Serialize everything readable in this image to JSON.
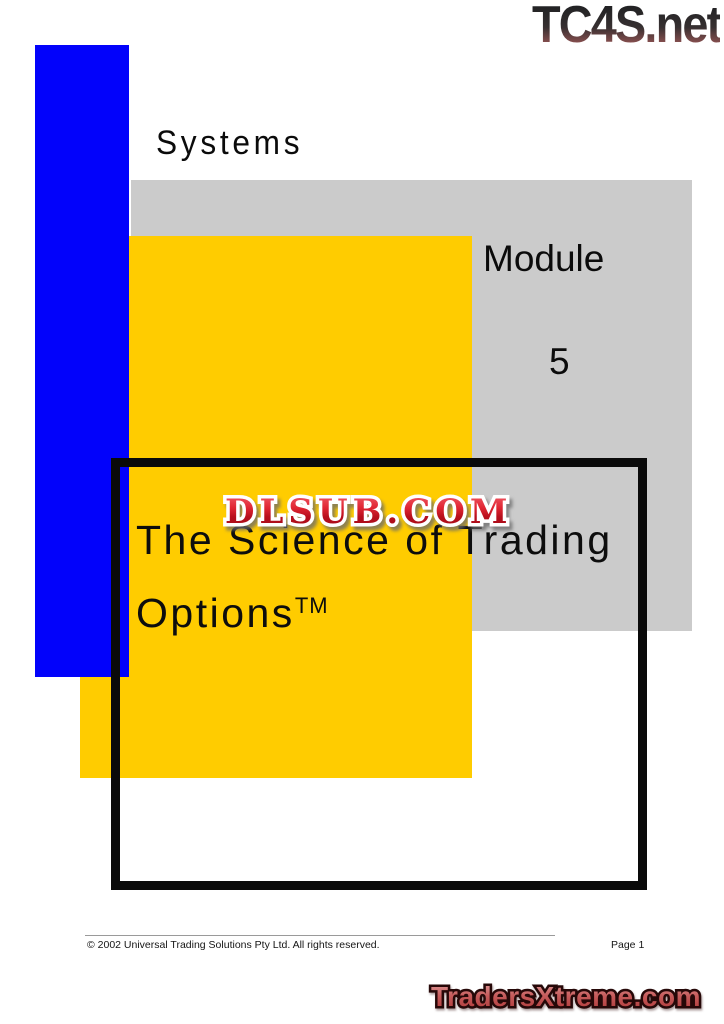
{
  "branding": {
    "tc4s": "TC4S.net",
    "dlsub": "DLSUB.COM",
    "tradersxtreme": "TradersXtreme.com"
  },
  "cover": {
    "series": "Systems",
    "module_label": "Module",
    "module_number": "5",
    "title_line1": "The Science of Trading",
    "title_line2": "Options",
    "trademark": "TM"
  },
  "footer": {
    "copyright": "© 2002 Universal Trading Solutions Pty Ltd. All rights reserved.",
    "page_label": "Page 1"
  },
  "colors": {
    "accent_blue": "#0202fb",
    "accent_yellow": "#ffcc00",
    "accent_gray": "#cbcbcb",
    "box_black": "#0a0a0a",
    "dlsub_red": "#c81225",
    "tradersxtreme_red": "#c05050",
    "tc4s_dark": "#232325"
  }
}
